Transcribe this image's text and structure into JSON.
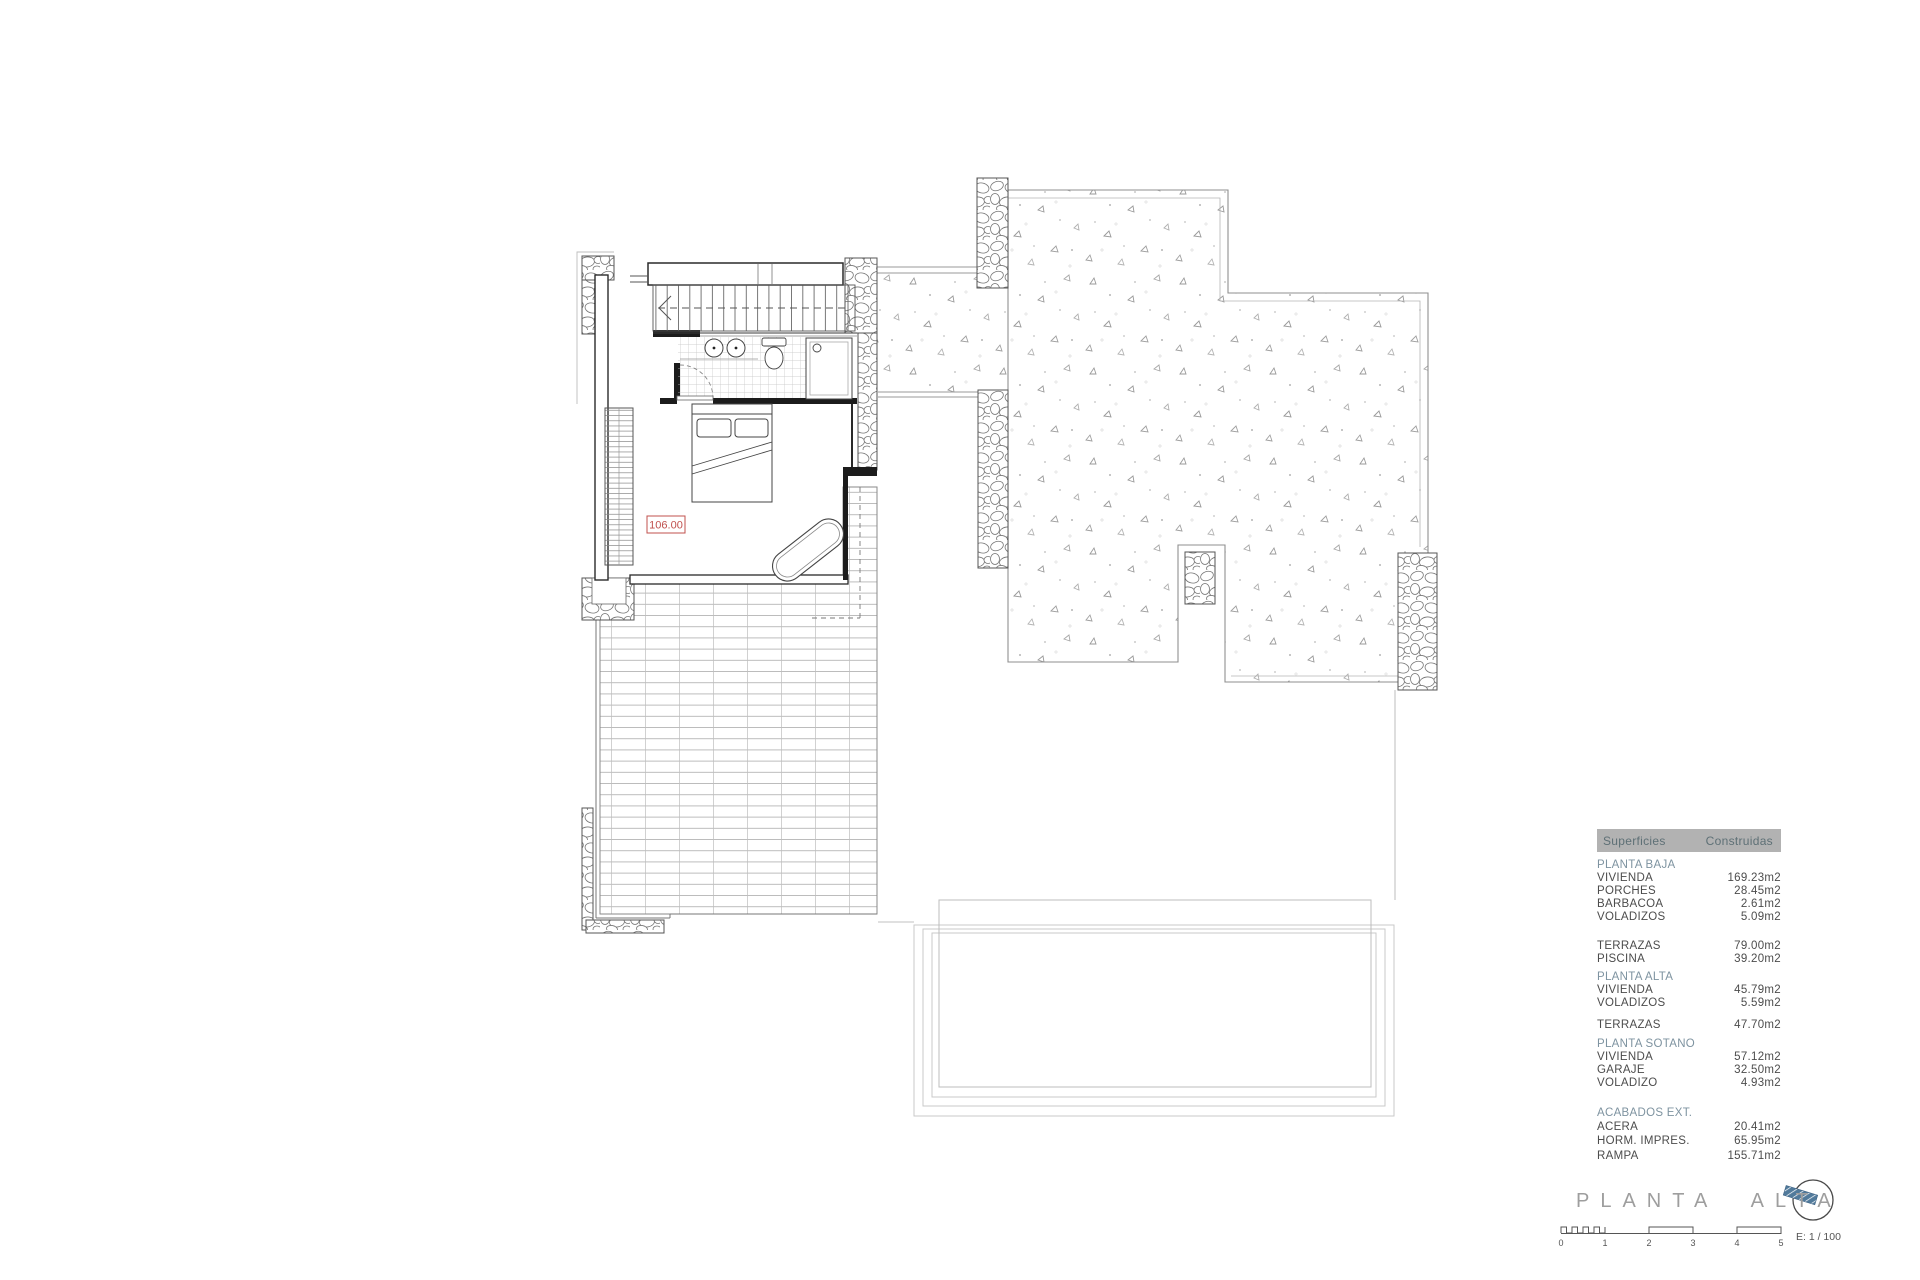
{
  "plan": {
    "dimension_label": "106.00"
  },
  "table": {
    "header": {
      "col1": "Superficies",
      "col2": "Construidas"
    },
    "sections": [
      {
        "title": "PLANTA BAJA",
        "rows": [
          {
            "label": "VIVIENDA",
            "value": "169.23m2"
          },
          {
            "label": "PORCHES",
            "value": "28.45m2"
          },
          {
            "label": "BARBACOA",
            "value": "2.61m2"
          },
          {
            "label": "VOLADIZOS",
            "value": "5.09m2"
          }
        ]
      },
      {
        "title": "",
        "rows": [
          {
            "label": "TERRAZAS",
            "value": "79.00m2"
          },
          {
            "label": "PISCINA",
            "value": "39.20m2"
          }
        ]
      },
      {
        "title": "PLANTA ALTA",
        "rows": [
          {
            "label": "VIVIENDA",
            "value": "45.79m2"
          },
          {
            "label": "VOLADIZOS",
            "value": "5.59m2"
          }
        ]
      },
      {
        "title": "",
        "rows": [
          {
            "label": "TERRAZAS",
            "value": "47.70m2"
          }
        ]
      },
      {
        "title": "PLANTA SOTANO",
        "rows": [
          {
            "label": "VIVIENDA",
            "value": "57.12m2"
          },
          {
            "label": "GARAJE",
            "value": "32.50m2"
          },
          {
            "label": "VOLADIZO",
            "value": "4.93m2"
          }
        ]
      },
      {
        "title": "ACABADOS EXT.",
        "rows": [
          {
            "label": "ACERA",
            "value": "20.41m2"
          },
          {
            "label": "HORM. IMPRES.",
            "value": "65.95m2"
          },
          {
            "label": "RAMPA",
            "value": "155.71m2"
          }
        ]
      }
    ]
  },
  "footer": {
    "title": "PLANTA ALTA",
    "scale_label": "E: 1 / 100",
    "scale_ticks": [
      "0",
      "1",
      "2",
      "3",
      "4",
      "5"
    ]
  },
  "colors": {
    "accent_red": "#c0504d",
    "section_blue": "#7e93a0",
    "header_bg": "#b2b2b2",
    "header_text": "#5e7076",
    "compass_blue": "#517a9b"
  }
}
